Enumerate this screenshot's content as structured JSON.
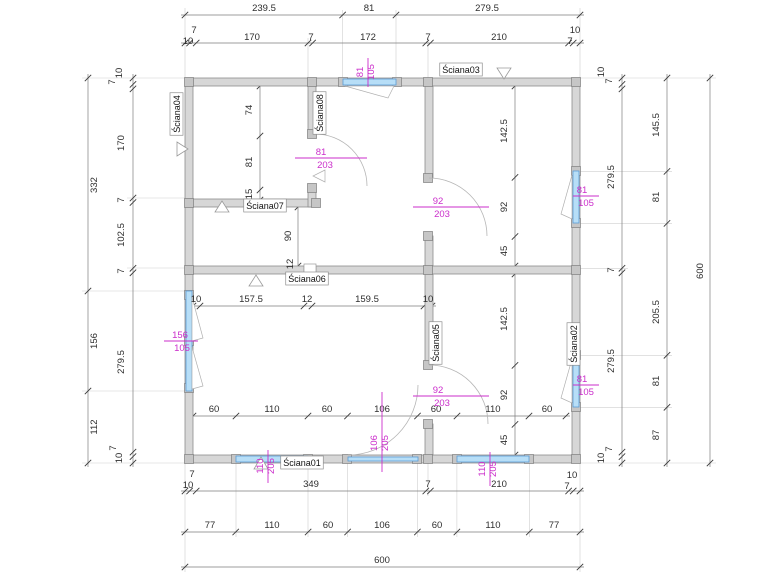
{
  "drawing": {
    "type": "floor-plan",
    "colors": {
      "opening_label": "#cb2ecb",
      "window_fill": "#b7def7",
      "wall_fill": "#d7d7d7",
      "dimension_text": "#2e2e2e"
    },
    "wall_labels": [
      {
        "text": "Ściana01",
        "x": 302,
        "y": 466,
        "r": 0
      },
      {
        "text": "Ściana02",
        "x": 577,
        "y": 344,
        "r": -90
      },
      {
        "text": "Ściana03",
        "x": 461,
        "y": 73,
        "r": 0
      },
      {
        "text": "Ściana04",
        "x": 180,
        "y": 114,
        "r": -90
      },
      {
        "text": "Ściana05",
        "x": 439,
        "y": 343,
        "r": -90
      },
      {
        "text": "Ściana06",
        "x": 307,
        "y": 282,
        "r": 0
      },
      {
        "text": "Ściana07",
        "x": 265,
        "y": 209,
        "r": 0
      },
      {
        "text": "Ściana08",
        "x": 323,
        "y": 113,
        "r": -90
      }
    ],
    "dim_labels": [
      {
        "t": "239.5",
        "x": 264,
        "y": 11,
        "r": 0
      },
      {
        "t": "81",
        "x": 369,
        "y": 11,
        "r": 0
      },
      {
        "t": "279.5",
        "x": 487,
        "y": 11,
        "r": 0
      },
      {
        "t": "7",
        "x": 194,
        "y": 33,
        "r": 0
      },
      {
        "t": "10",
        "x": 188,
        "y": 44,
        "r": 0
      },
      {
        "t": "170",
        "x": 252,
        "y": 40,
        "r": 0
      },
      {
        "t": "7",
        "x": 311,
        "y": 40,
        "r": 0
      },
      {
        "t": "172",
        "x": 368,
        "y": 40,
        "r": 0
      },
      {
        "t": "7",
        "x": 428,
        "y": 40,
        "r": 0
      },
      {
        "t": "210",
        "x": 499,
        "y": 40,
        "r": 0
      },
      {
        "t": "10",
        "x": 575,
        "y": 33,
        "r": 0
      },
      {
        "t": "7",
        "x": 570,
        "y": 44,
        "r": 0
      },
      {
        "t": "10",
        "x": 196,
        "y": 302,
        "r": 0
      },
      {
        "t": "157.5",
        "x": 251,
        "y": 302,
        "r": 0
      },
      {
        "t": "12",
        "x": 307,
        "y": 302,
        "r": 0
      },
      {
        "t": "159.5",
        "x": 367,
        "y": 302,
        "r": 0
      },
      {
        "t": "10",
        "x": 428,
        "y": 302,
        "r": 0
      },
      {
        "t": "60",
        "x": 214,
        "y": 412,
        "r": 0
      },
      {
        "t": "110",
        "x": 272,
        "y": 412,
        "r": 0
      },
      {
        "t": "60",
        "x": 327,
        "y": 412,
        "r": 0
      },
      {
        "t": "106",
        "x": 382,
        "y": 412,
        "r": 0
      },
      {
        "t": "60",
        "x": 436,
        "y": 412,
        "r": 0
      },
      {
        "t": "110",
        "x": 493,
        "y": 412,
        "r": 0
      },
      {
        "t": "60",
        "x": 547,
        "y": 412,
        "r": 0
      },
      {
        "t": "7",
        "x": 192,
        "y": 477,
        "r": 0
      },
      {
        "t": "10",
        "x": 188,
        "y": 488,
        "r": 0
      },
      {
        "t": "349",
        "x": 311,
        "y": 487,
        "r": 0
      },
      {
        "t": "7",
        "x": 428,
        "y": 487,
        "r": 0
      },
      {
        "t": "210",
        "x": 499,
        "y": 487,
        "r": 0
      },
      {
        "t": "10",
        "x": 572,
        "y": 478,
        "r": 0
      },
      {
        "t": "7",
        "x": 567,
        "y": 489,
        "r": 0
      },
      {
        "t": "77",
        "x": 210,
        "y": 528,
        "r": 0
      },
      {
        "t": "110",
        "x": 272,
        "y": 528,
        "r": 0
      },
      {
        "t": "60",
        "x": 328,
        "y": 528,
        "r": 0
      },
      {
        "t": "106",
        "x": 382,
        "y": 528,
        "r": 0
      },
      {
        "t": "60",
        "x": 437,
        "y": 528,
        "r": 0
      },
      {
        "t": "110",
        "x": 493,
        "y": 528,
        "r": 0
      },
      {
        "t": "77",
        "x": 554,
        "y": 528,
        "r": 0
      },
      {
        "t": "600",
        "x": 382,
        "y": 563,
        "r": 0
      },
      {
        "t": "332",
        "x": 97,
        "y": 185,
        "r": -90
      },
      {
        "t": "156",
        "x": 97,
        "y": 341,
        "r": -90
      },
      {
        "t": "112",
        "x": 97,
        "y": 427,
        "r": -90
      },
      {
        "t": "10",
        "x": 122,
        "y": 73,
        "r": -90
      },
      {
        "t": "7",
        "x": 115,
        "y": 82,
        "r": -90
      },
      {
        "t": "170",
        "x": 124,
        "y": 143,
        "r": -90
      },
      {
        "t": "7",
        "x": 124,
        "y": 200,
        "r": -90
      },
      {
        "t": "102.5",
        "x": 124,
        "y": 235,
        "r": -90
      },
      {
        "t": "7",
        "x": 124,
        "y": 271,
        "r": -90
      },
      {
        "t": "279.5",
        "x": 124,
        "y": 362,
        "r": -90
      },
      {
        "t": "7",
        "x": 116,
        "y": 448,
        "r": -90
      },
      {
        "t": "10",
        "x": 122,
        "y": 458,
        "r": -90
      },
      {
        "t": "74",
        "x": 252,
        "y": 110,
        "r": -90
      },
      {
        "t": "81",
        "x": 252,
        "y": 162,
        "r": -90
      },
      {
        "t": "15",
        "x": 252,
        "y": 194,
        "r": -90
      },
      {
        "t": "90",
        "x": 291,
        "y": 236,
        "r": -90
      },
      {
        "t": "12",
        "x": 293,
        "y": 264,
        "r": -90
      },
      {
        "t": "142.5",
        "x": 507,
        "y": 131,
        "r": -90
      },
      {
        "t": "92",
        "x": 507,
        "y": 207,
        "r": -90
      },
      {
        "t": "45",
        "x": 507,
        "y": 251,
        "r": -90
      },
      {
        "t": "142.5",
        "x": 507,
        "y": 319,
        "r": -90
      },
      {
        "t": "92",
        "x": 507,
        "y": 395,
        "r": -90
      },
      {
        "t": "45",
        "x": 507,
        "y": 440,
        "r": -90
      },
      {
        "t": "10",
        "x": 604,
        "y": 72,
        "r": -90
      },
      {
        "t": "7",
        "x": 612,
        "y": 81,
        "r": -90
      },
      {
        "t": "279.5",
        "x": 614,
        "y": 177,
        "r": -90
      },
      {
        "t": "7",
        "x": 614,
        "y": 270,
        "r": -90
      },
      {
        "t": "279.5",
        "x": 614,
        "y": 361,
        "r": -90
      },
      {
        "t": "7",
        "x": 612,
        "y": 449,
        "r": -90
      },
      {
        "t": "10",
        "x": 604,
        "y": 458,
        "r": -90
      },
      {
        "t": "145.5",
        "x": 659,
        "y": 125,
        "r": -90
      },
      {
        "t": "81",
        "x": 659,
        "y": 197,
        "r": -90
      },
      {
        "t": "205.5",
        "x": 659,
        "y": 312,
        "r": -90
      },
      {
        "t": "81",
        "x": 659,
        "y": 381,
        "r": -90
      },
      {
        "t": "87",
        "x": 659,
        "y": 435,
        "r": -90
      },
      {
        "t": "600",
        "x": 703,
        "y": 271,
        "r": -90
      }
    ],
    "opening_labels": [
      {
        "num": "81",
        "den": "105",
        "np": [
          363,
          72
        ],
        "dp": [
          374,
          72
        ],
        "r": -90,
        "line": [
          368,
          58,
          368,
          87
        ]
      },
      {
        "num": "81",
        "den": "203",
        "np": [
          321,
          155
        ],
        "dp": [
          325,
          168
        ],
        "r": 0,
        "line": [
          295,
          158,
          367,
          158
        ]
      },
      {
        "num": "92",
        "den": "203",
        "np": [
          438,
          204
        ],
        "dp": [
          442,
          217
        ],
        "r": 0,
        "line": [
          413,
          207,
          489,
          207
        ]
      },
      {
        "num": "81",
        "den": "105",
        "np": [
          582,
          193
        ],
        "dp": [
          586,
          206
        ],
        "r": 0,
        "line": [
          573,
          196,
          599,
          196
        ]
      },
      {
        "num": "156",
        "den": "105",
        "np": [
          180,
          338
        ],
        "dp": [
          182,
          351
        ],
        "r": 0,
        "line": [
          164,
          341,
          198,
          341
        ]
      },
      {
        "num": "92",
        "den": "203",
        "np": [
          438,
          393
        ],
        "dp": [
          442,
          406
        ],
        "r": 0,
        "line": [
          413,
          396,
          489,
          396
        ]
      },
      {
        "num": "81",
        "den": "105",
        "np": [
          582,
          382
        ],
        "dp": [
          586,
          395
        ],
        "r": 0,
        "line": [
          573,
          385,
          599,
          385
        ]
      },
      {
        "num": "106",
        "den": "205",
        "np": [
          377,
          443
        ],
        "dp": [
          388,
          443
        ],
        "r": -90,
        "line": [
          382,
          392,
          382,
          472
        ]
      },
      {
        "num": "110",
        "den": "205",
        "np": [
          263,
          466
        ],
        "dp": [
          274,
          466
        ],
        "r": -90,
        "line": [
          268,
          450,
          268,
          483
        ]
      },
      {
        "num": "110",
        "den": "205",
        "np": [
          485,
          469
        ],
        "dp": [
          496,
          469
        ],
        "r": -90,
        "line": [
          490,
          452,
          490,
          486
        ]
      }
    ]
  }
}
